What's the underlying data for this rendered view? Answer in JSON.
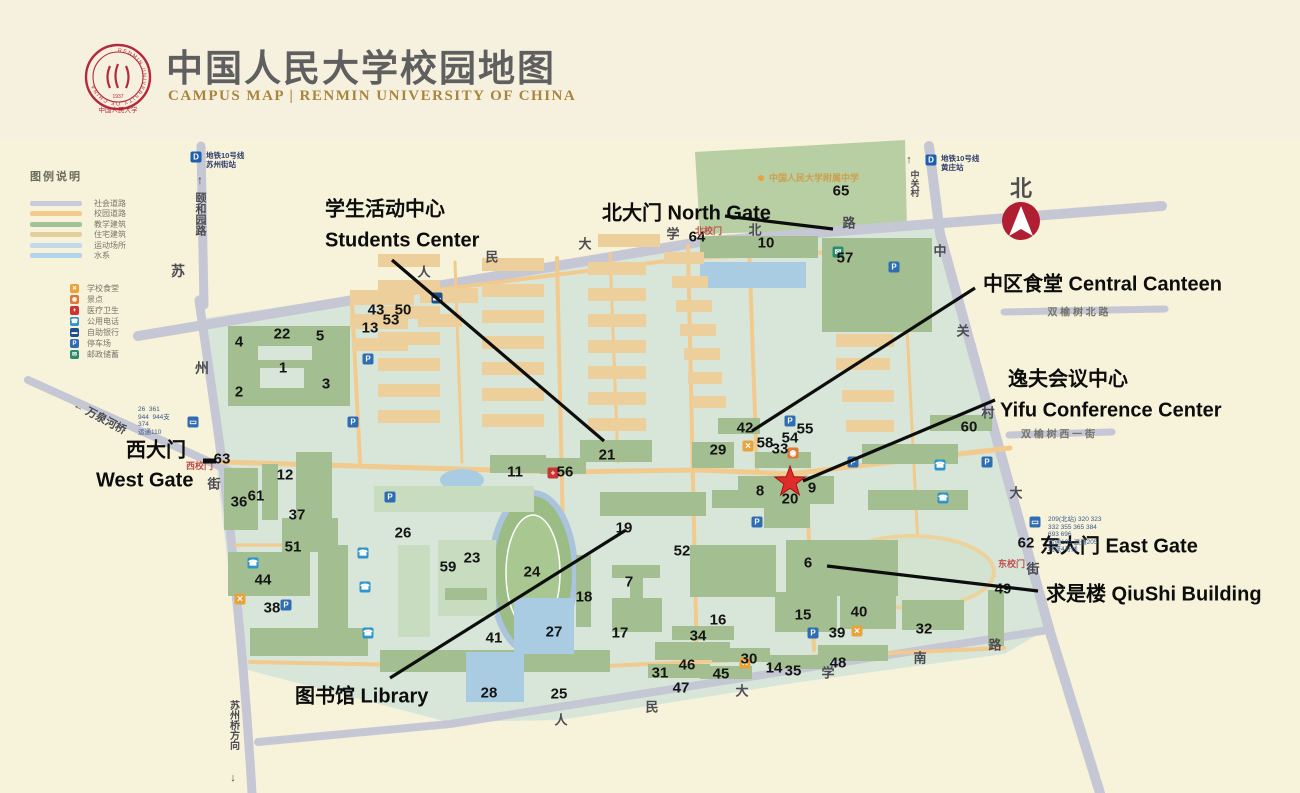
{
  "header": {
    "title": "中国人民大学校园地图",
    "subtitle": "CAMPUS MAP | RENMIN UNIVERSITY OF CHINA",
    "logo": {
      "ring_text": "RENMIN UNIVERSITY OF CHINA",
      "year": "1937",
      "cn_name": "中国人民大学"
    }
  },
  "compass": {
    "label": "北"
  },
  "colors": {
    "page_bg": "#f6f1de",
    "campus_bg": "#d7e6d9",
    "academic_green": "#a3bf92",
    "residential_tan": "#eccf9b",
    "campus_road": "#f2ca8d",
    "city_road": "#c6c7d4",
    "water": "#a9cce3",
    "light_block": "#c8dcc0",
    "annotation": "#0d0d0d",
    "gate_red": "#c0504d",
    "star_red": "#e02b2b",
    "seal_red": "#b5293a",
    "gold": "#a9853e"
  },
  "legend": {
    "title": "图例说明",
    "roads": [
      {
        "label": "社会道路",
        "color": "#c9cada"
      },
      {
        "label": "校园道路",
        "color": "#f2ca8d"
      },
      {
        "label": "教学建筑",
        "color": "#a2c29a"
      },
      {
        "label": "住宅建筑",
        "color": "#e3cf9d"
      },
      {
        "label": "运动场所",
        "color": "#c2d9ea"
      },
      {
        "label": "水系",
        "color": "#b3d3ea"
      }
    ],
    "icons": [
      {
        "label": "学校食堂",
        "type": "food"
      },
      {
        "label": "景点",
        "type": "scenic"
      },
      {
        "label": "医疗卫生",
        "type": "med"
      },
      {
        "label": "公用电话",
        "type": "tel"
      },
      {
        "label": "自助银行",
        "type": "atm"
      },
      {
        "label": "停车场",
        "type": "P"
      },
      {
        "label": "邮政储蓄",
        "type": "post"
      }
    ]
  },
  "metro_stations": [
    {
      "line": "地铁10号线",
      "station": "苏州街站",
      "x": 196,
      "y": 157
    },
    {
      "line": "地铁10号线",
      "station": "黄庄站",
      "x": 931,
      "y": 160
    }
  ],
  "annotations": [
    {
      "id": "students-center-cn",
      "text": "学生活动中心",
      "x": 325,
      "y": 207
    },
    {
      "id": "students-center-en",
      "text": "Students Center",
      "x": 325,
      "y": 241
    },
    {
      "id": "north-gate",
      "text": "北大门 North Gate",
      "x": 602,
      "y": 211
    },
    {
      "id": "central-canteen",
      "text": "中区食堂 Central Canteen",
      "x": 983,
      "y": 282
    },
    {
      "id": "yifu-cn",
      "text": "逸夫会议中心",
      "x": 1008,
      "y": 377
    },
    {
      "id": "yifu-en",
      "text": "Yifu Conference Center",
      "x": 1000,
      "y": 411
    },
    {
      "id": "west-gate-cn",
      "text": "西大门",
      "x": 126,
      "y": 448
    },
    {
      "id": "west-gate-en",
      "text": "West Gate",
      "x": 96,
      "y": 481
    },
    {
      "id": "east-gate",
      "text": "东大门 East Gate",
      "x": 1040,
      "y": 544
    },
    {
      "id": "qiushi",
      "text": "求是楼 QiuShi Building",
      "x": 1046,
      "y": 592
    },
    {
      "id": "library",
      "text": "图书馆 Library",
      "x": 295,
      "y": 694
    }
  ],
  "road_labels": [
    {
      "text": "人",
      "x": 424,
      "y": 271,
      "s": 13
    },
    {
      "text": "民",
      "x": 492,
      "y": 256,
      "s": 13
    },
    {
      "text": "大",
      "x": 585,
      "y": 243,
      "s": 13
    },
    {
      "text": "学",
      "x": 673,
      "y": 233,
      "s": 13
    },
    {
      "text": "北",
      "x": 755,
      "y": 229,
      "s": 13
    },
    {
      "text": "路",
      "x": 849,
      "y": 222,
      "s": 13
    },
    {
      "text": "人",
      "x": 561,
      "y": 719,
      "s": 13
    },
    {
      "text": "民",
      "x": 652,
      "y": 706,
      "s": 13
    },
    {
      "text": "大",
      "x": 742,
      "y": 690,
      "s": 13
    },
    {
      "text": "学",
      "x": 828,
      "y": 672,
      "s": 13
    },
    {
      "text": "南",
      "x": 920,
      "y": 657,
      "s": 13
    },
    {
      "text": "路",
      "x": 995,
      "y": 644,
      "s": 13
    },
    {
      "text": "苏",
      "x": 178,
      "y": 271,
      "s": 14
    },
    {
      "text": "州",
      "x": 202,
      "y": 368,
      "s": 14
    },
    {
      "text": "街",
      "x": 214,
      "y": 483,
      "s": 13
    },
    {
      "text": "中",
      "x": 940,
      "y": 250,
      "s": 13
    },
    {
      "text": "关",
      "x": 963,
      "y": 330,
      "s": 13
    },
    {
      "text": "村",
      "x": 988,
      "y": 412,
      "s": 13
    },
    {
      "text": "大",
      "x": 1016,
      "y": 492,
      "s": 13
    },
    {
      "text": "街",
      "x": 1033,
      "y": 568,
      "s": 13
    },
    {
      "text": "↑",
      "x": 200,
      "y": 180,
      "s": 12
    },
    {
      "text": "颐和园路",
      "x": 200,
      "y": 192,
      "s": 11,
      "v": 1
    },
    {
      "text": "↑",
      "x": 909,
      "y": 160,
      "s": 11
    },
    {
      "text": "中关村",
      "x": 915,
      "y": 170,
      "s": 9,
      "v": 1
    },
    {
      "text": "苏州桥方向",
      "x": 233,
      "y": 700,
      "s": 10,
      "v": 1
    },
    {
      "text": "↓",
      "x": 233,
      "y": 778,
      "s": 11
    },
    {
      "text": "双 榆 树 北 路",
      "x": 1078,
      "y": 311,
      "s": 10,
      "c": "#74746c"
    },
    {
      "text": "双 榆 树 西 一 街",
      "x": 1058,
      "y": 433,
      "s": 10,
      "c": "#74746c"
    },
    {
      "text": "← 万泉河桥",
      "x": 100,
      "y": 417,
      "s": 11,
      "r": 28
    }
  ],
  "gate_labels": [
    {
      "text": "北校门",
      "x": 695,
      "y": 224
    },
    {
      "text": "西校门",
      "x": 186,
      "y": 459
    },
    {
      "text": "东校门",
      "x": 998,
      "y": 557
    }
  ],
  "poi_labels": [
    {
      "text": "中国人民大学附属中学",
      "x": 758,
      "y": 171,
      "color": "#cf9f4e",
      "dot": "#e8a33d"
    }
  ],
  "bus_routes": [
    {
      "id": "west-gate-routes",
      "x": 138,
      "y": 406,
      "lines": [
        "26  361",
        "944  944支",
        "374",
        "运通110"
      ]
    },
    {
      "id": "east-gate-routes",
      "x": 1048,
      "y": 516,
      "lines": [
        "209(北站) 320 323",
        "332 355 365 384",
        "693 696",
        "运通105 运通205",
        "地铁4号线"
      ]
    }
  ],
  "numbers": [
    [
      1,
      283,
      368
    ],
    [
      2,
      239,
      392
    ],
    [
      3,
      326,
      384
    ],
    [
      4,
      239,
      342
    ],
    [
      5,
      320,
      336
    ],
    [
      6,
      808,
      563
    ],
    [
      7,
      629,
      582
    ],
    [
      8,
      760,
      491
    ],
    [
      9,
      812,
      488
    ],
    [
      10,
      766,
      243
    ],
    [
      11,
      515,
      472
    ],
    [
      12,
      285,
      475
    ],
    [
      13,
      370,
      328
    ],
    [
      14,
      774,
      668
    ],
    [
      15,
      803,
      615
    ],
    [
      16,
      718,
      620
    ],
    [
      17,
      620,
      633
    ],
    [
      18,
      584,
      597
    ],
    [
      19,
      624,
      528
    ],
    [
      20,
      790,
      499
    ],
    [
      21,
      607,
      455
    ],
    [
      22,
      282,
      334
    ],
    [
      23,
      472,
      558
    ],
    [
      24,
      532,
      572
    ],
    [
      25,
      559,
      694
    ],
    [
      26,
      403,
      533
    ],
    [
      27,
      554,
      632
    ],
    [
      28,
      489,
      693
    ],
    [
      29,
      718,
      450
    ],
    [
      30,
      749,
      659
    ],
    [
      31,
      660,
      673
    ],
    [
      32,
      924,
      629
    ],
    [
      33,
      780,
      449
    ],
    [
      34,
      698,
      636
    ],
    [
      35,
      793,
      671
    ],
    [
      36,
      239,
      502
    ],
    [
      37,
      297,
      515
    ],
    [
      38,
      272,
      608
    ],
    [
      39,
      837,
      633
    ],
    [
      40,
      859,
      612
    ],
    [
      41,
      494,
      638
    ],
    [
      42,
      745,
      428
    ],
    [
      43,
      376,
      310
    ],
    [
      44,
      263,
      580
    ],
    [
      45,
      721,
      674
    ],
    [
      46,
      687,
      665
    ],
    [
      47,
      681,
      688
    ],
    [
      48,
      838,
      663
    ],
    [
      49,
      1003,
      589
    ],
    [
      50,
      403,
      310
    ],
    [
      51,
      293,
      547
    ],
    [
      52,
      682,
      551
    ],
    [
      53,
      391,
      320
    ],
    [
      54,
      790,
      438
    ],
    [
      55,
      805,
      429
    ],
    [
      56,
      565,
      472
    ],
    [
      57,
      845,
      258
    ],
    [
      58,
      765,
      443
    ],
    [
      59,
      448,
      567
    ],
    [
      60,
      969,
      427
    ],
    [
      61,
      256,
      496
    ],
    [
      62,
      1026,
      543
    ],
    [
      63,
      222,
      459
    ],
    [
      64,
      697,
      237
    ],
    [
      65,
      841,
      191
    ]
  ],
  "map_icons": [
    [
      "P",
      368,
      359
    ],
    [
      "P",
      353,
      422
    ],
    [
      "P",
      390,
      497
    ],
    [
      "P",
      286,
      605
    ],
    [
      "P",
      790,
      421
    ],
    [
      "P",
      853,
      462
    ],
    [
      "P",
      987,
      462
    ],
    [
      "P",
      757,
      522
    ],
    [
      "P",
      894,
      267
    ],
    [
      "P",
      813,
      633
    ],
    [
      "tel",
      253,
      563
    ],
    [
      "tel",
      363,
      553
    ],
    [
      "tel",
      365,
      587
    ],
    [
      "tel",
      368,
      633
    ],
    [
      "tel",
      940,
      465
    ],
    [
      "tel",
      943,
      498
    ],
    [
      "med",
      553,
      473
    ],
    [
      "food",
      748,
      446
    ],
    [
      "food",
      240,
      599
    ],
    [
      "food",
      857,
      631
    ],
    [
      "food",
      745,
      663
    ],
    [
      "scenic",
      793,
      453
    ],
    [
      "post",
      838,
      252
    ],
    [
      "atm",
      437,
      298
    ],
    [
      "bus",
      193,
      422
    ],
    [
      "bus",
      1035,
      522
    ],
    [
      "metro",
      196,
      157
    ],
    [
      "metro",
      931,
      160
    ]
  ],
  "buildings": [
    [
      228,
      326,
      122,
      80,
      "g"
    ],
    [
      258,
      346,
      54,
      14,
      "c"
    ],
    [
      260,
      368,
      44,
      20,
      "c"
    ],
    [
      700,
      236,
      118,
      22,
      "g"
    ],
    [
      700,
      262,
      106,
      26,
      "w"
    ],
    [
      822,
      238,
      110,
      94,
      "g"
    ],
    [
      930,
      415,
      62,
      16,
      "g"
    ],
    [
      862,
      444,
      96,
      20,
      "g"
    ],
    [
      868,
      490,
      100,
      20,
      "g"
    ],
    [
      718,
      418,
      42,
      16,
      "g"
    ],
    [
      692,
      442,
      42,
      26,
      "g"
    ],
    [
      755,
      452,
      56,
      16,
      "g"
    ],
    [
      738,
      476,
      96,
      28,
      "g"
    ],
    [
      764,
      502,
      46,
      26,
      "g"
    ],
    [
      690,
      545,
      86,
      52,
      "g"
    ],
    [
      786,
      540,
      112,
      56,
      "g"
    ],
    [
      600,
      492,
      106,
      24,
      "g"
    ],
    [
      712,
      490,
      56,
      18,
      "g"
    ],
    [
      580,
      440,
      72,
      22,
      "g"
    ],
    [
      490,
      455,
      56,
      18,
      "g"
    ],
    [
      540,
      458,
      46,
      16,
      "g"
    ],
    [
      612,
      565,
      48,
      13,
      "g"
    ],
    [
      630,
      576,
      13,
      30,
      "g"
    ],
    [
      576,
      555,
      15,
      72,
      "g"
    ],
    [
      612,
      598,
      50,
      34,
      "g"
    ],
    [
      672,
      626,
      62,
      14,
      "g"
    ],
    [
      655,
      642,
      75,
      18,
      "g"
    ],
    [
      648,
      664,
      62,
      14,
      "g"
    ],
    [
      775,
      592,
      62,
      40,
      "g"
    ],
    [
      840,
      585,
      56,
      44,
      "g"
    ],
    [
      902,
      600,
      62,
      30,
      "g"
    ],
    [
      712,
      648,
      58,
      14,
      "g"
    ],
    [
      700,
      666,
      52,
      13,
      "g"
    ],
    [
      768,
      655,
      62,
      14,
      "g"
    ],
    [
      818,
      645,
      70,
      16,
      "g"
    ],
    [
      988,
      590,
      16,
      56,
      "g"
    ],
    [
      224,
      468,
      34,
      62,
      "g"
    ],
    [
      262,
      464,
      16,
      56,
      "g"
    ],
    [
      296,
      452,
      36,
      86,
      "g"
    ],
    [
      282,
      518,
      56,
      34,
      "g"
    ],
    [
      228,
      552,
      82,
      44,
      "g"
    ],
    [
      318,
      545,
      30,
      96,
      "g"
    ],
    [
      250,
      628,
      118,
      28,
      "g"
    ],
    [
      380,
      650,
      230,
      22,
      "g"
    ],
    [
      398,
      545,
      32,
      92,
      "lg"
    ],
    [
      438,
      540,
      58,
      76,
      "lg"
    ],
    [
      445,
      588,
      42,
      12,
      "g"
    ],
    [
      466,
      652,
      58,
      50,
      "w"
    ],
    [
      514,
      598,
      60,
      56,
      "w"
    ],
    [
      374,
      486,
      160,
      26,
      "lg"
    ],
    [
      350,
      290,
      64,
      15,
      "t"
    ],
    [
      350,
      314,
      58,
      15,
      "t"
    ],
    [
      420,
      288,
      58,
      15,
      "t"
    ],
    [
      418,
      314,
      44,
      13,
      "t"
    ],
    [
      352,
      338,
      56,
      13,
      "t"
    ],
    [
      378,
      254,
      62,
      13,
      "t"
    ],
    [
      482,
      258,
      62,
      13,
      "t"
    ],
    [
      588,
      262,
      58,
      13,
      "t"
    ],
    [
      378,
      280,
      62,
      13,
      "t"
    ],
    [
      482,
      284,
      62,
      13,
      "t"
    ],
    [
      588,
      288,
      58,
      13,
      "t"
    ],
    [
      378,
      306,
      62,
      13,
      "t"
    ],
    [
      482,
      310,
      62,
      13,
      "t"
    ],
    [
      588,
      314,
      58,
      13,
      "t"
    ],
    [
      378,
      332,
      62,
      13,
      "t"
    ],
    [
      482,
      336,
      62,
      13,
      "t"
    ],
    [
      588,
      340,
      58,
      13,
      "t"
    ],
    [
      378,
      358,
      62,
      13,
      "t"
    ],
    [
      482,
      362,
      62,
      13,
      "t"
    ],
    [
      588,
      366,
      58,
      13,
      "t"
    ],
    [
      378,
      384,
      62,
      13,
      "t"
    ],
    [
      482,
      388,
      62,
      13,
      "t"
    ],
    [
      588,
      392,
      58,
      13,
      "t"
    ],
    [
      378,
      410,
      62,
      13,
      "t"
    ],
    [
      482,
      414,
      62,
      13,
      "t"
    ],
    [
      588,
      418,
      58,
      13,
      "t"
    ],
    [
      664,
      252,
      40,
      12,
      "t"
    ],
    [
      672,
      276,
      36,
      12,
      "t"
    ],
    [
      676,
      300,
      36,
      12,
      "t"
    ],
    [
      680,
      324,
      36,
      12,
      "t"
    ],
    [
      684,
      348,
      36,
      12,
      "t"
    ],
    [
      688,
      372,
      34,
      12,
      "t"
    ],
    [
      692,
      396,
      34,
      12,
      "t"
    ],
    [
      836,
      334,
      58,
      13,
      "t"
    ],
    [
      836,
      358,
      54,
      12,
      "t"
    ],
    [
      842,
      390,
      52,
      12,
      "t"
    ],
    [
      846,
      420,
      48,
      12,
      "t"
    ],
    [
      598,
      234,
      62,
      13,
      "t"
    ]
  ],
  "star": {
    "x": 790,
    "y": 482
  }
}
